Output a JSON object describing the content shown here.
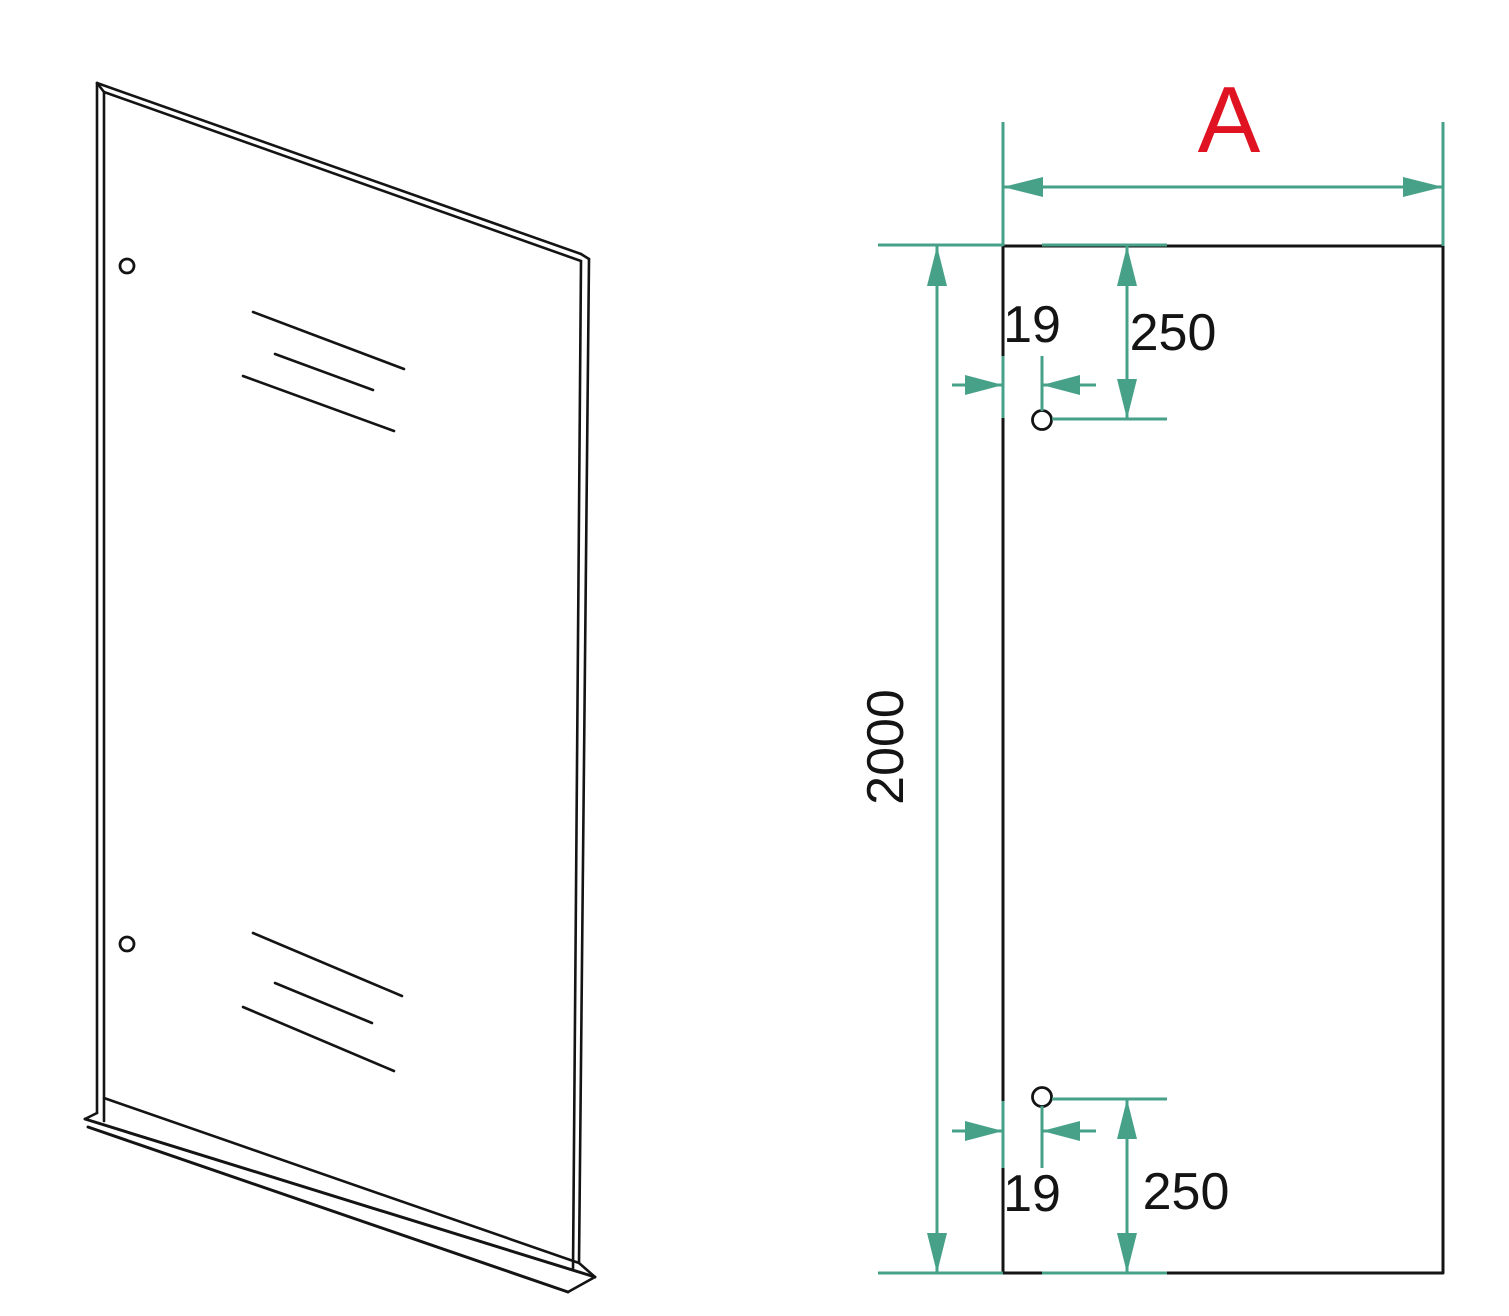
{
  "drawing": {
    "front_view": {
      "width_label": "A",
      "height_dim": "2000",
      "top_hole": {
        "offset_from_edge": "19",
        "offset_from_top": "250"
      },
      "bottom_hole": {
        "offset_from_edge": "19",
        "offset_from_bottom": "250"
      }
    }
  },
  "colors": {
    "line": "#141414",
    "dimension": "#47a189",
    "accent": "#df1321",
    "background": "#ffffff"
  }
}
